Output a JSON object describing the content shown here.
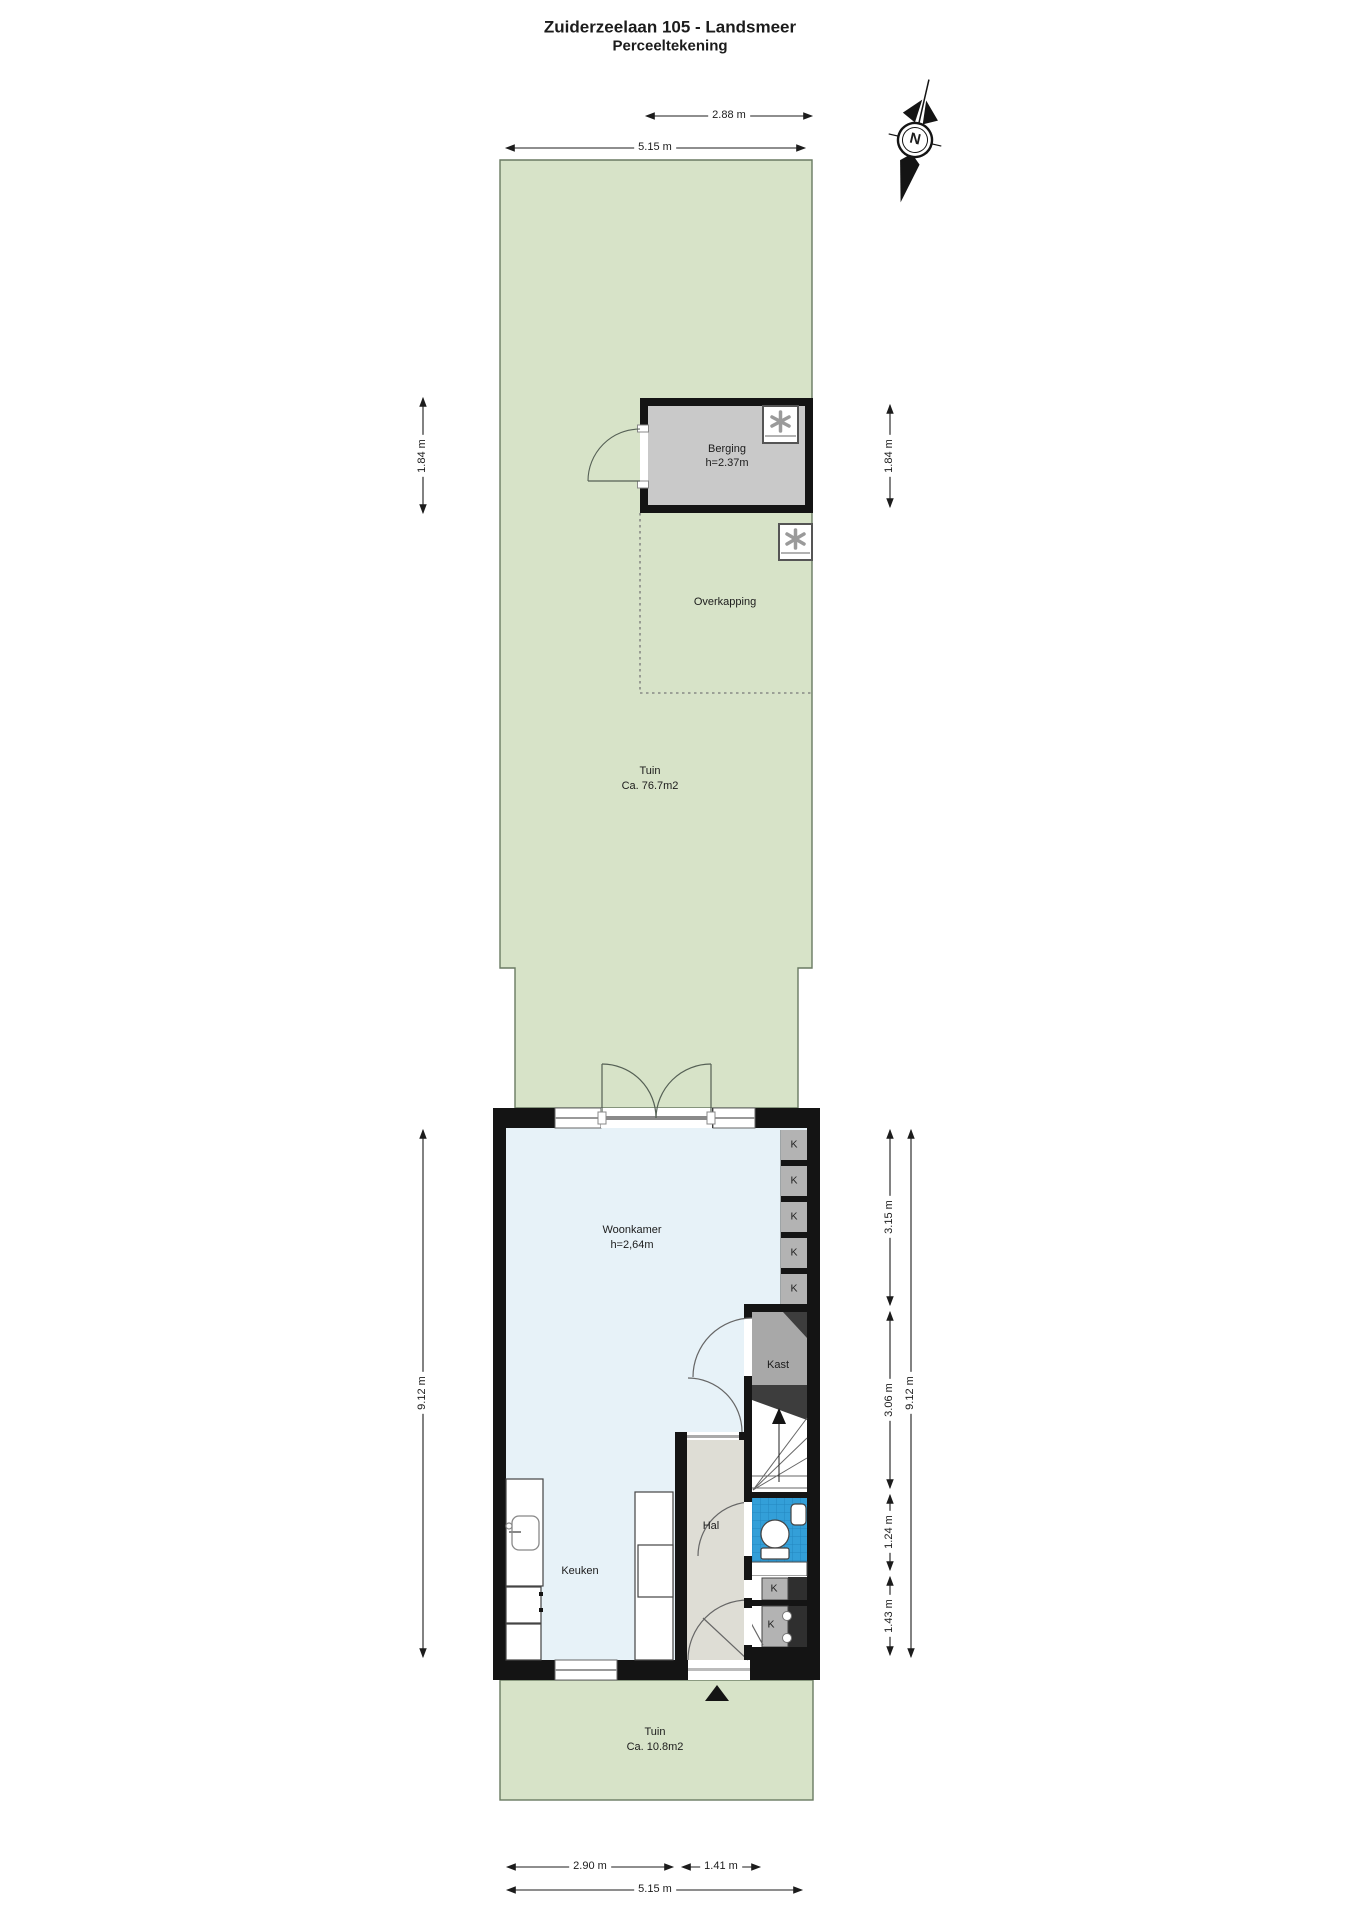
{
  "title": {
    "line1": "Zuiderzeelaan 105 - Landsmeer",
    "line2": "Perceeltekening"
  },
  "compass": {
    "label": "N"
  },
  "rooms": {
    "berging": {
      "name": "Berging",
      "height": "h=2.37m"
    },
    "overkapping": {
      "name": "Overkapping"
    },
    "tuin_back": {
      "name": "Tuin",
      "area": "Ca. 76.7m2"
    },
    "woonkamer": {
      "name": "Woonkamer",
      "height": "h=2,64m"
    },
    "keuken": {
      "name": "Keuken"
    },
    "hal": {
      "name": "Hal"
    },
    "kast": {
      "name": "Kast"
    },
    "closet_label": "K",
    "tuin_front": {
      "name": "Tuin",
      "area": "Ca. 10.8m2"
    }
  },
  "dimensions": {
    "shed_width": "2.88 m",
    "plot_width_top": "5.15 m",
    "shed_depth_left": "1.84 m",
    "shed_depth_right": "1.84 m",
    "house_depth_left": "9.12 m",
    "house_depth_right": "9.12 m",
    "living_depth": "3.15 m",
    "mid_depth": "3.06 m",
    "bath_depth": "1.24 m",
    "entry_depth": "1.43 m",
    "garden_front_left": "2.90 m",
    "garden_front_door": "1.41 m",
    "plot_width_bottom": "5.15 m"
  },
  "colors": {
    "garden_green": "#d7e3c8",
    "garden_border": "#6a7a62",
    "wall_black": "#141414",
    "floor_blue": "#e7f2f8",
    "hal_gray": "#deddd5",
    "bath_blue": "#339fd8",
    "bath_grout": "#2387bf",
    "shed_gray": "#c9c9c9",
    "closet_gray": "#b3b3b3",
    "kast_gray": "#a8a8a8",
    "shaft_dark": "#2f2f2f"
  }
}
